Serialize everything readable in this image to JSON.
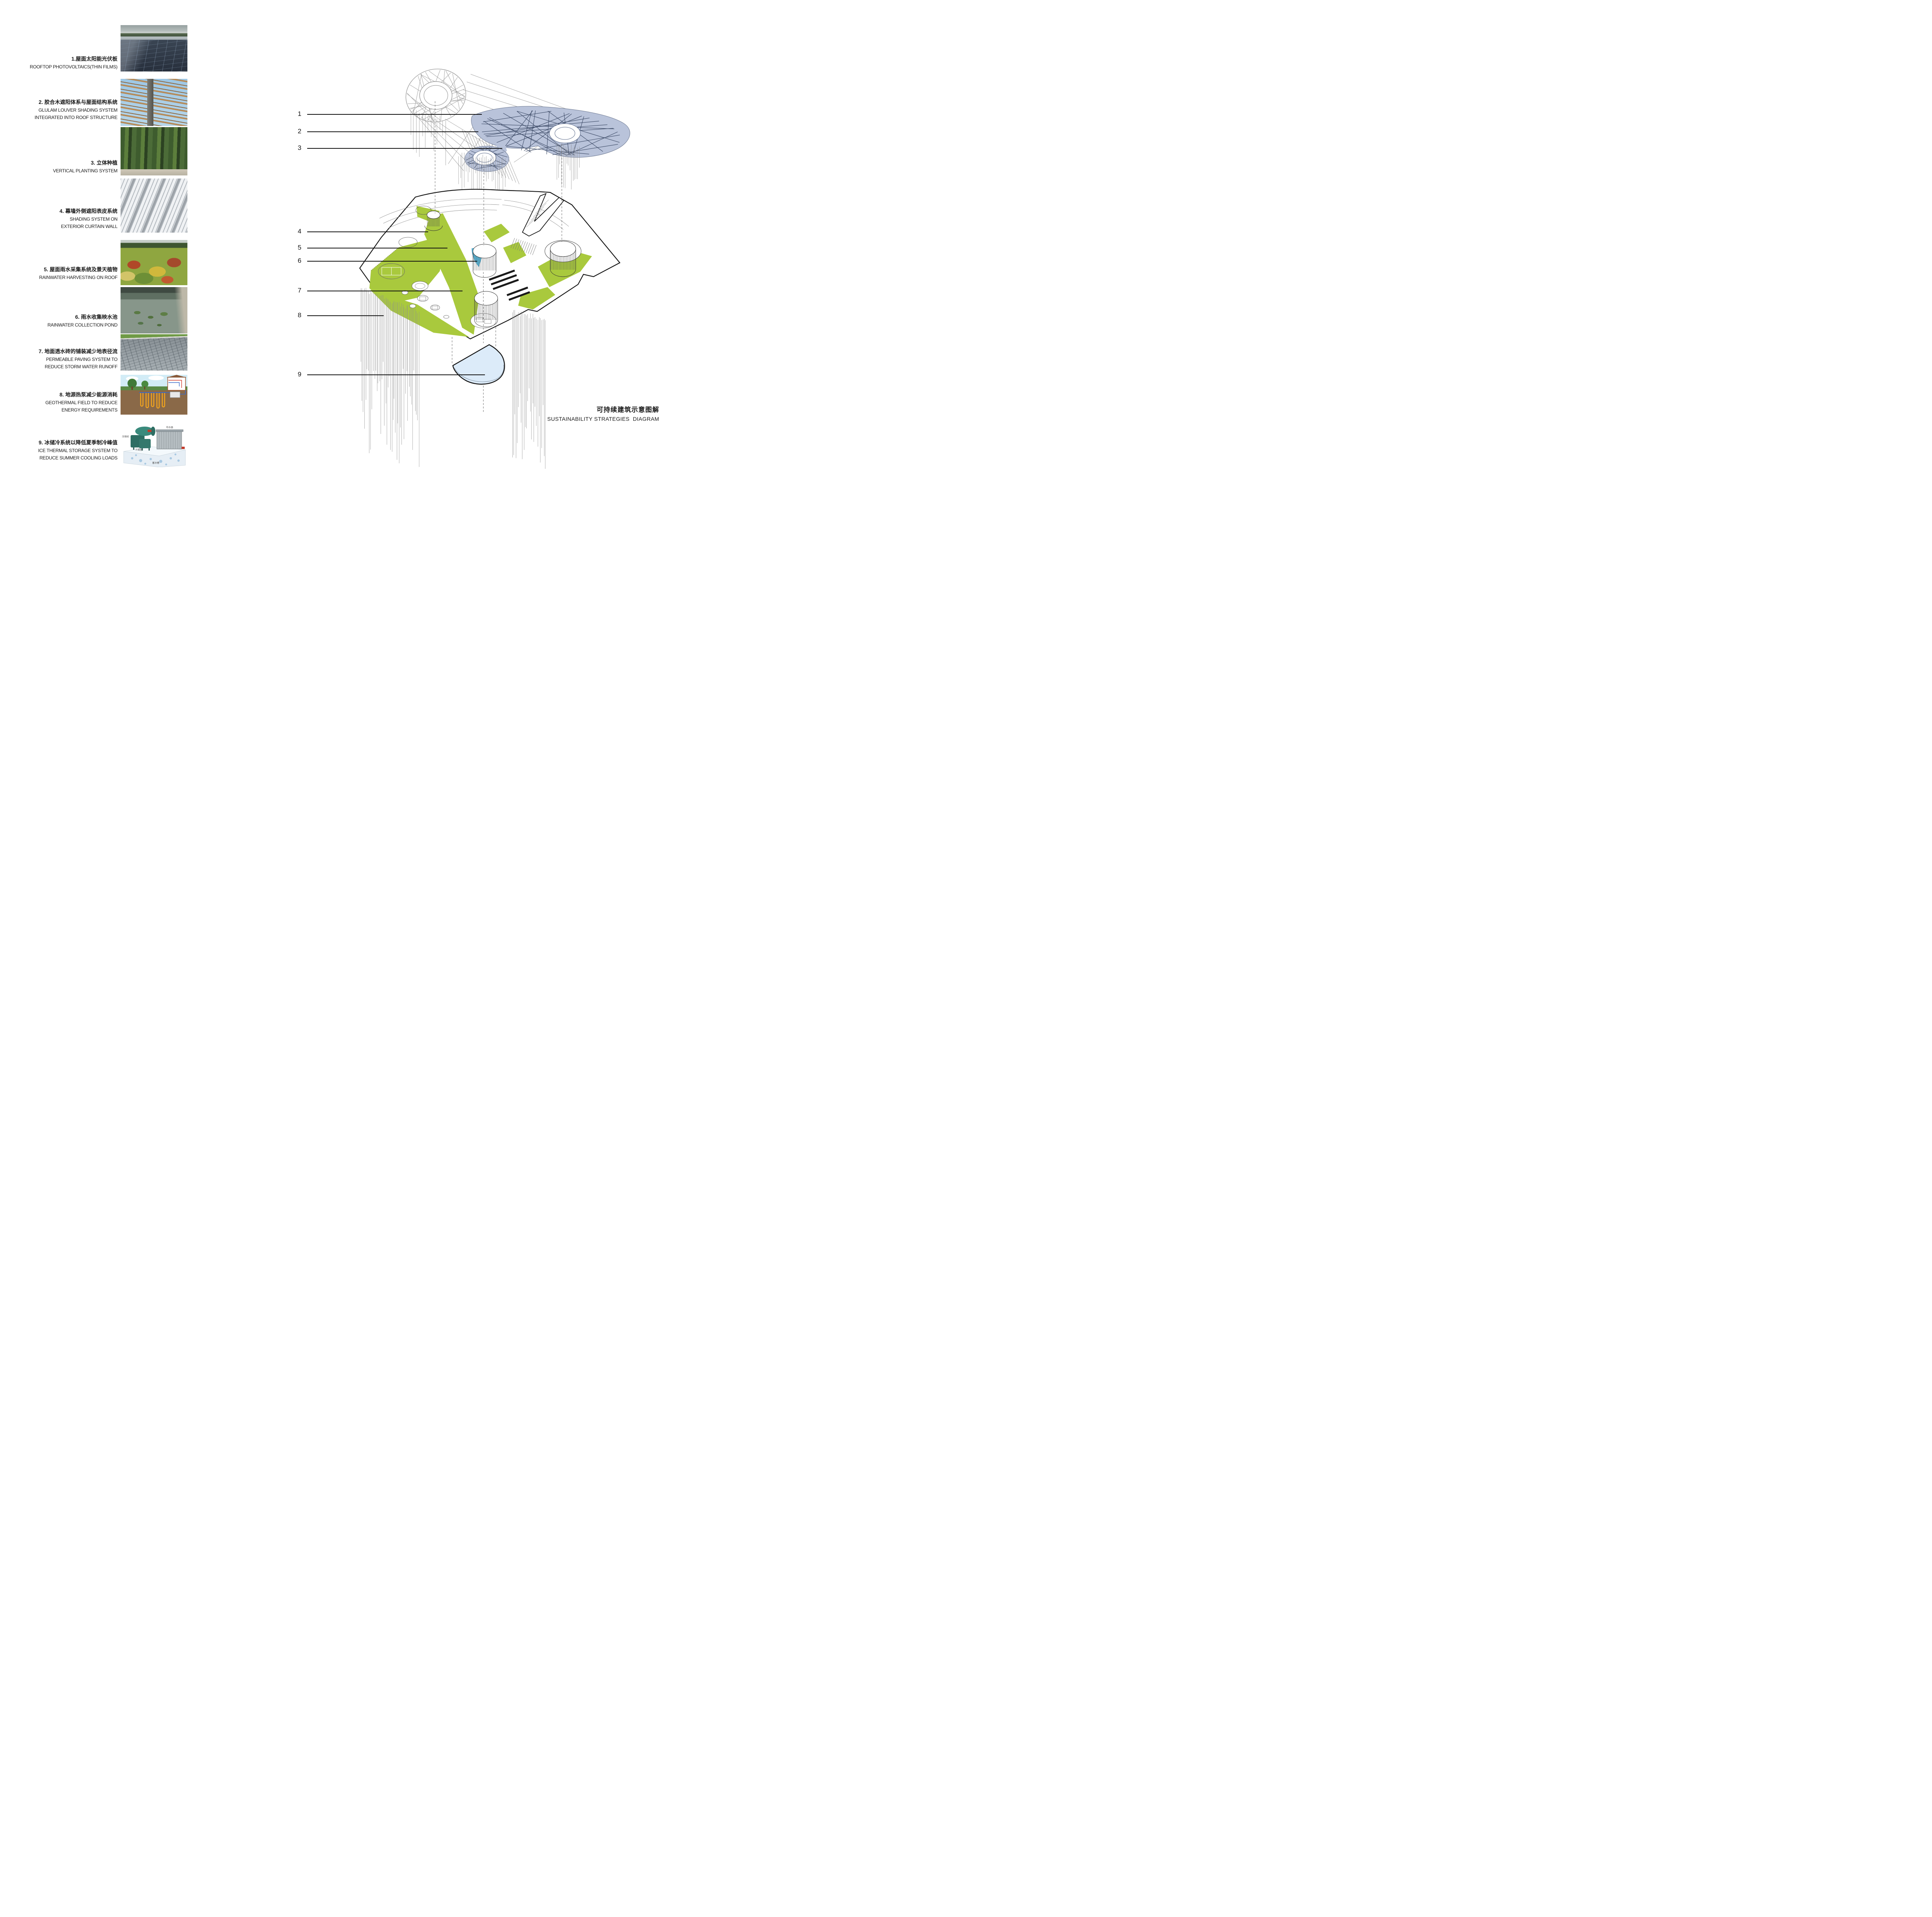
{
  "page": {
    "title_zh": "可持续建筑示意图解",
    "title_en": "SUSTAINABILITY STRATEGIES  DIAGRAM"
  },
  "colors": {
    "canopy_blue": "#b9c3da",
    "canopy_grid_navy": "#3c4a66",
    "structure_gray": "#9b9b9b",
    "site_green": "#a9c93d",
    "pond_blue_small": "#56b5d8",
    "pond_slab_blue": "#dcebf9",
    "outline_black": "#141414"
  },
  "legend": {
    "items": [
      {
        "num": "1",
        "zh": "1.屋面太阳能光伏板",
        "en1": "ROOFTOP PHOTOVOLTAICS(THIN FILMS)",
        "en2": ""
      },
      {
        "num": "2",
        "zh": "2. 胶合木遮阳体系与屋面结构系统",
        "en1": "GLULAM LOUVER SHADING SYSTEM",
        "en2": "INTEGRATED INTO ROOF STRUCTURE"
      },
      {
        "num": "3",
        "zh": "3. 立体种植",
        "en1": "VERTICAL PLANTING SYSTEM",
        "en2": ""
      },
      {
        "num": "4",
        "zh": "4. 幕墙外侧遮阳表皮系统",
        "en1": "SHADING SYSTEM ON",
        "en2": "EXTERIOR CURTAIN WALL"
      },
      {
        "num": "5",
        "zh": "5. 屋面雨水采集系统及景天植物",
        "en1": "RAINWATER HARVESTING ON ROOF",
        "en2": ""
      },
      {
        "num": "6",
        "zh": "6. 雨水收集映水池",
        "en1": "RAINWATER COLLECTION POND",
        "en2": ""
      },
      {
        "num": "7",
        "zh": "7. 地面透水砖的铺装减少地表径流",
        "en1": "PERMEABLE PAVING SYSTEM TO",
        "en2": "REDUCE STORM WATER RUNOFF"
      },
      {
        "num": "8",
        "zh": "8. 地源热泵减少能源消耗",
        "en1": "GEOTHERMAL FIELD TO REDUCE",
        "en2": "ENERGY REQUIREMENTS"
      },
      {
        "num": "9",
        "zh": "9. 冰储冷系统以降低夏季制冷峰值",
        "en1": "ICE THERMAL STORAGE SYSTEM TO",
        "en2": "REDUCE SUMMER COOLING LOADS"
      }
    ]
  },
  "photos": {
    "ice_labels": [
      "压缩机",
      "冷凝器",
      "布水器",
      "蓄冰槽"
    ]
  }
}
